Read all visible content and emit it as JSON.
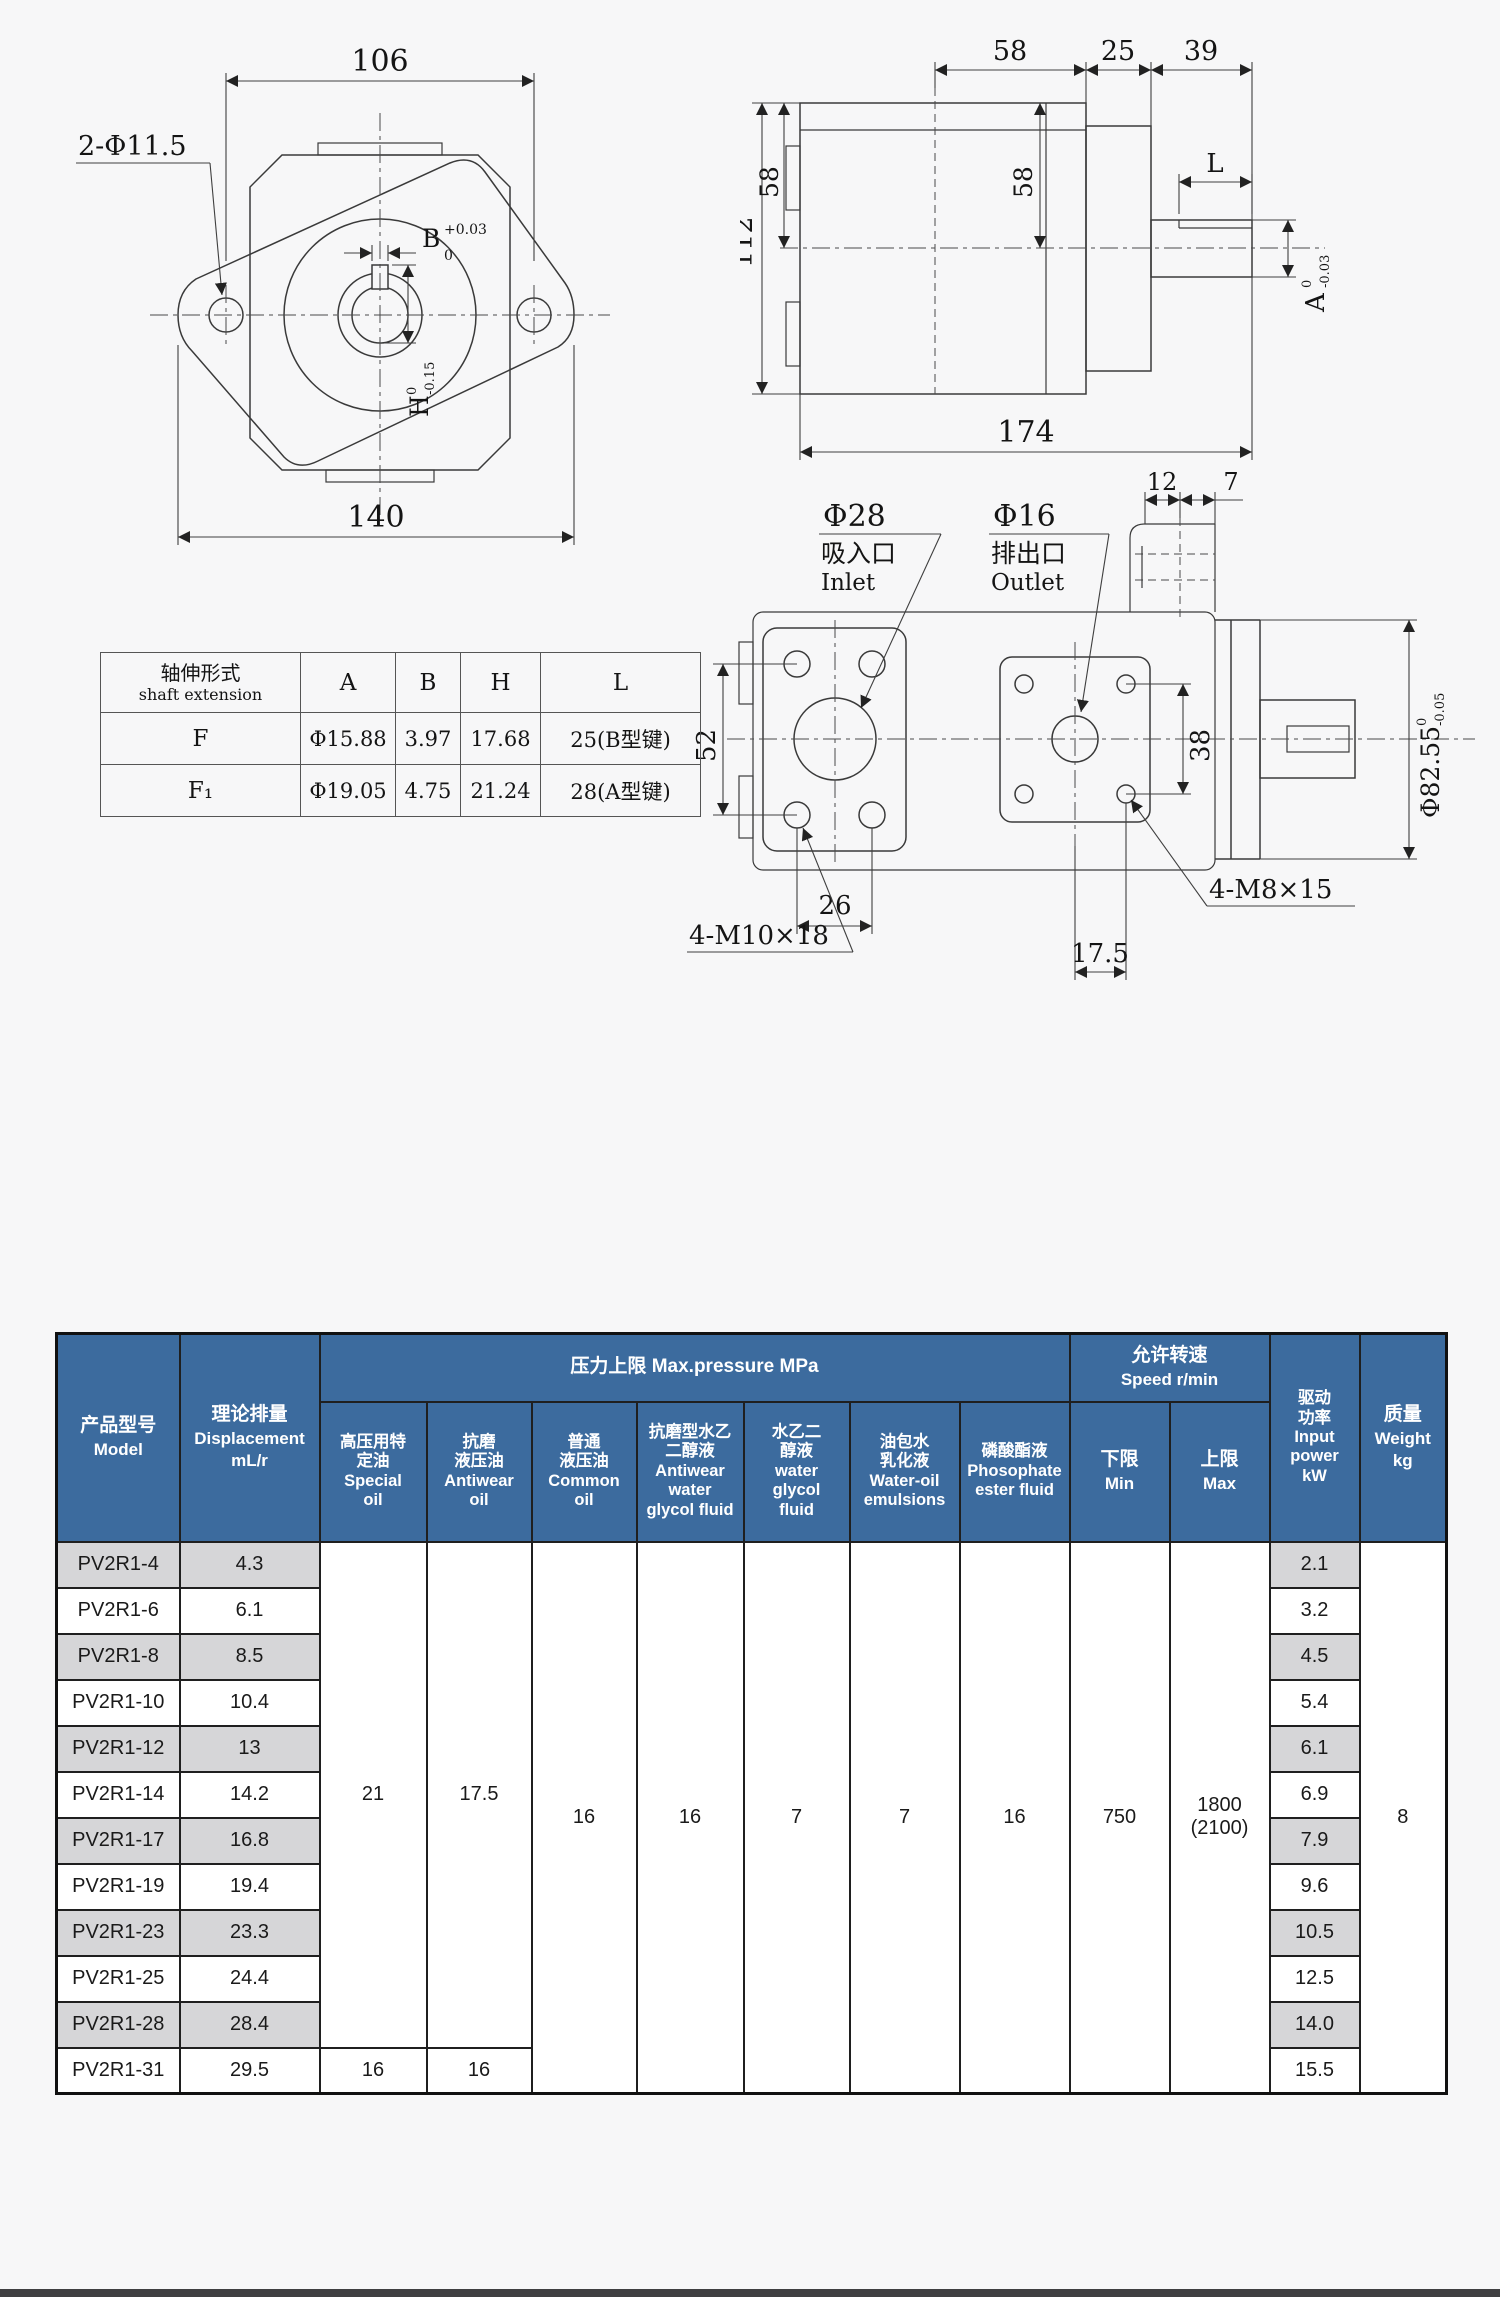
{
  "front_view": {
    "dim_width_top": "106",
    "dim_width_bottom": "140",
    "holes_label": "2-Φ11.5",
    "keyway_width": {
      "letter": "B",
      "upper": "+0.03",
      "lower": "0"
    },
    "keyway_height": {
      "letter": "H",
      "upper": "0",
      "lower": "-0.15"
    }
  },
  "side_view": {
    "dim_58_top": "58",
    "dim_25": "25",
    "dim_39": "39",
    "dim_112": "112",
    "dim_58_left": "58",
    "dim_58_inner": "58",
    "dim_L": "L",
    "shaft_tol": {
      "letter": "A",
      "upper": "0",
      "lower": "-0.03"
    },
    "dim_174": "174"
  },
  "port_view": {
    "inlet": {
      "dia": "Φ28",
      "zh": "吸入口",
      "en": "Inlet"
    },
    "outlet": {
      "dia": "Φ16",
      "zh": "排出口",
      "en": "Outlet"
    },
    "dim_12": "12",
    "dim_7": "7",
    "dim_52": "52",
    "dim_26": "26",
    "dim_17_5": "17.5",
    "dim_38": "38",
    "m10_label": "4-M10×18",
    "m8_label": "4-M8×15",
    "spigot_tol": {
      "letter": "Φ82.55",
      "upper": "0",
      "lower": "-0.05"
    }
  },
  "shaft_table": {
    "title_zh": "轴伸形式",
    "title_en": "shaft extension",
    "col_a": "A",
    "col_b": "B",
    "col_h": "H",
    "col_l": "L",
    "rows": [
      {
        "type": "F",
        "a": "Φ15.88",
        "b": "3.97",
        "h": "17.68",
        "l": "25(B型键)"
      },
      {
        "type": "F₁",
        "a": "Φ19.05",
        "b": "4.75",
        "h": "21.24",
        "l": "28(A型键)"
      }
    ]
  },
  "spec_table": {
    "colors": {
      "header_bg": "#3c6b9e",
      "header_fg": "#ffffff",
      "alt_row": "#d6d6d8",
      "border": "#1f1f1f"
    },
    "model_h": {
      "zh": "产品型号",
      "en": "Model"
    },
    "disp_h": {
      "zh": "理论排量",
      "en": "Displacement",
      "unit": "mL/r"
    },
    "pressure_h": "压力上限 Max.pressure MPa",
    "oil_cols": [
      {
        "zh1": "高压用特",
        "zh2": "定油",
        "en1": "Special",
        "en2": "oil"
      },
      {
        "zh1": "抗磨",
        "zh2": "液压油",
        "en1": "Antiwear",
        "en2": "oil"
      },
      {
        "zh1": "普通",
        "zh2": "液压油",
        "en1": "Common",
        "en2": "oil"
      },
      {
        "zh1": "抗磨型水乙",
        "zh2": "二醇液",
        "en1": "Antiwear",
        "en2": "water",
        "en3": "glycol fluid"
      },
      {
        "zh1": "水乙二",
        "zh2": "醇液",
        "en1": "water",
        "en2": "glycol",
        "en3": "fluid"
      },
      {
        "zh1": "油包水",
        "zh2": "乳化液",
        "en1": "Water-oil",
        "en2": "emulsions"
      },
      {
        "zh1": "磷酸酯液",
        "en1": "Phosophate",
        "en2": "ester fluid"
      }
    ],
    "speed_h": {
      "zh": "允许转速",
      "en": "Speed r/min"
    },
    "min_h": {
      "zh": "下限",
      "en": "Min"
    },
    "max_h": {
      "zh": "上限",
      "en": "Max"
    },
    "power_h": {
      "zh1": "驱动",
      "zh2": "功率",
      "en1": "Input",
      "en2": "power",
      "unit": "kW"
    },
    "weight_h": {
      "zh": "质量",
      "en": "Weight",
      "unit": "kg"
    },
    "rows": [
      {
        "model": "PV2R1-4",
        "disp": "4.3",
        "power": "2.1"
      },
      {
        "model": "PV2R1-6",
        "disp": "6.1",
        "power": "3.2"
      },
      {
        "model": "PV2R1-8",
        "disp": "8.5",
        "power": "4.5"
      },
      {
        "model": "PV2R1-10",
        "disp": "10.4",
        "power": "5.4"
      },
      {
        "model": "PV2R1-12",
        "disp": "13",
        "power": "6.1"
      },
      {
        "model": "PV2R1-14",
        "disp": "14.2",
        "power": "6.9"
      },
      {
        "model": "PV2R1-17",
        "disp": "16.8",
        "power": "7.9"
      },
      {
        "model": "PV2R1-19",
        "disp": "19.4",
        "power": "9.6"
      },
      {
        "model": "PV2R1-23",
        "disp": "23.3",
        "power": "10.5"
      },
      {
        "model": "PV2R1-25",
        "disp": "24.4",
        "power": "12.5"
      },
      {
        "model": "PV2R1-28",
        "disp": "28.4",
        "power": "14.0"
      },
      {
        "model": "PV2R1-31",
        "disp": "29.5",
        "power": "15.5"
      }
    ],
    "merged": {
      "special": "21",
      "antiwear": "17.5",
      "common": "16",
      "antiwear_glycol": "16",
      "water_glycol": "7",
      "water_oil": "7",
      "phosphate": "16",
      "min": "750",
      "max1": "1800",
      "max2": "(2100)",
      "weight": "8",
      "row12_special": "16",
      "row12_antiwear": "16"
    }
  }
}
